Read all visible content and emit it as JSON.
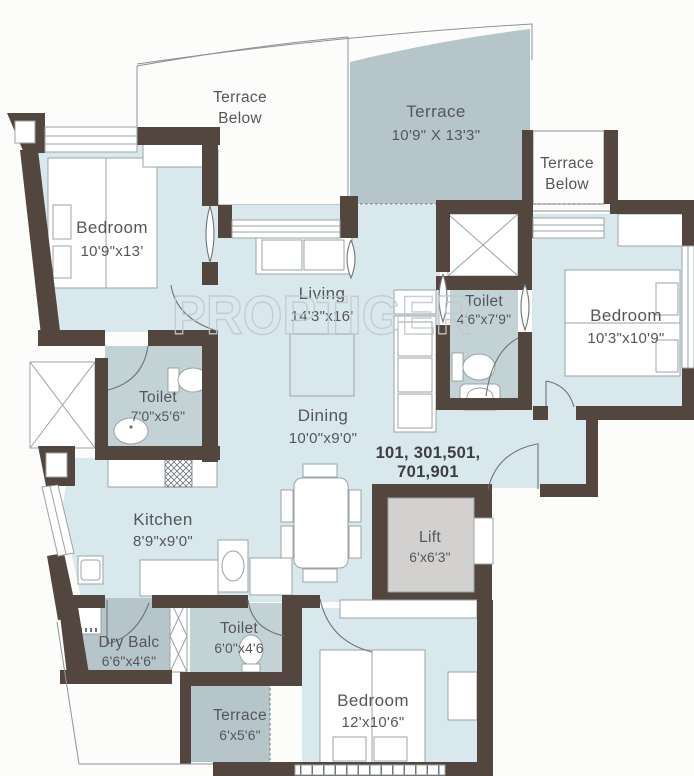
{
  "watermark": "PROPTIGER",
  "unit_numbers": {
    "line1": "101, 301,501,",
    "line2": "701,901"
  },
  "rooms": {
    "terrace_below_left": {
      "line1": "Terrace",
      "line2": "Below"
    },
    "terrace_main": {
      "line1": "Terrace",
      "line2": "10'9\" X 13'3\""
    },
    "terrace_below_right": {
      "line1": "Terrace",
      "line2": "Below"
    },
    "bedroom_left": {
      "line1": "Bedroom",
      "line2": "10'9\"x13'"
    },
    "living": {
      "line1": "Living",
      "line2": "14'3\"x16'"
    },
    "toilet_common": {
      "line1": "Toilet",
      "line2": "4'6\"x7'9\""
    },
    "bedroom_right": {
      "line1": "Bedroom",
      "line2": "10'3\"x10'9\""
    },
    "toilet_master": {
      "line1": "Toilet",
      "line2": "7'0\"x5'6\""
    },
    "dining": {
      "line1": "Dining",
      "line2": "10'0\"x9'0\""
    },
    "kitchen": {
      "line1": "Kitchen",
      "line2": "8'9\"x9'0\""
    },
    "lift": {
      "line1": "Lift",
      "line2": "6'x6'3\""
    },
    "dry_balcony": {
      "line1": "Dry Balc",
      "line2": "6'6\"x4'6\""
    },
    "toilet_bottom": {
      "line1": "Toilet",
      "line2": "6'0\"x4'6"
    },
    "terrace_bottom": {
      "line1": "Terrace",
      "line2": "6'x5'6\""
    },
    "bedroom_bottom": {
      "line1": "Bedroom",
      "line2": "12'x10'6\""
    }
  },
  "colors": {
    "wall": "#52463f",
    "room_fill": "#d9e8ec",
    "toilet_fill": "#c3d2d4",
    "terrace_fill": "#b5c5c9",
    "lift_fill": "#d2d1cf",
    "label_text": "#54565a",
    "outline": "#9aa3a6",
    "watermark": "#c3c8cb"
  }
}
